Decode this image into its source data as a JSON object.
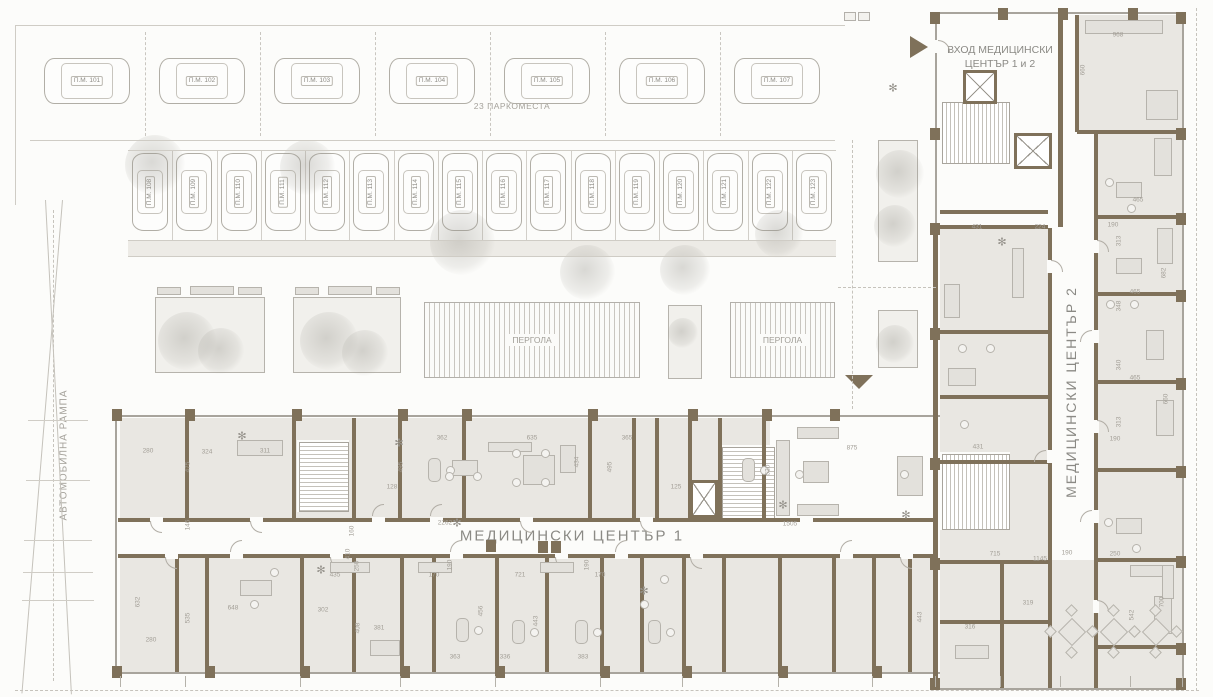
{
  "site": {
    "parking_total_label": "23 ПАРКОМЕСТА",
    "ramp_label": "АВТОМОБИЛНА РАМПА",
    "pergola_labels": [
      "ПЕРГОЛА",
      "ПЕРГОЛА"
    ]
  },
  "building": {
    "entrance_label": "ВХОД МЕДИЦИНСКИ ЦЕНТЪР 1 и 2",
    "center1_label": "МЕДИЦИНСКИ ЦЕНТЪР 1",
    "center2_label": "МЕДИЦИНСКИ ЦЕНТЪР 2"
  },
  "parking": {
    "row_top": [
      "П.М. 101",
      "П.М. 102",
      "П.М. 103",
      "П.М. 104",
      "П.М. 105",
      "П.М. 106",
      "П.М. 107"
    ],
    "row_middle": [
      "П.М. 108",
      "П.М. 109",
      "П.М. 110",
      "П.М. 111",
      "П.М. 112",
      "П.М. 113",
      "П.М. 114",
      "П.М. 115",
      "П.М. 116",
      "П.М. 117",
      "П.М. 118",
      "П.М. 119",
      "П.М. 120",
      "П.М. 121",
      "П.М. 122",
      "П.М. 123"
    ]
  },
  "colors": {
    "wall": "#7f715a",
    "floor": "#e9e7e2",
    "line_gray": "#a8a49c",
    "label_text": "#8b8a85",
    "dim_text": "#a29e96"
  },
  "dimensions": [
    {
      "t": "2262",
      "x": 445,
      "y": 523,
      "r": 0
    },
    {
      "t": "1505",
      "x": 790,
      "y": 524,
      "r": 0
    },
    {
      "t": "875",
      "x": 852,
      "y": 448,
      "r": 0
    },
    {
      "t": "362",
      "x": 442,
      "y": 438,
      "r": 0
    },
    {
      "t": "635",
      "x": 532,
      "y": 438,
      "r": 0
    },
    {
      "t": "365",
      "x": 627,
      "y": 438,
      "r": 0
    },
    {
      "t": "495",
      "x": 401,
      "y": 467,
      "r": 90
    },
    {
      "t": "495",
      "x": 610,
      "y": 467,
      "r": 90
    },
    {
      "t": "434",
      "x": 577,
      "y": 462,
      "r": 90
    },
    {
      "t": "128",
      "x": 392,
      "y": 487,
      "r": 0
    },
    {
      "t": "125",
      "x": 676,
      "y": 487,
      "r": 0
    },
    {
      "t": "324",
      "x": 207,
      "y": 452,
      "r": 0
    },
    {
      "t": "280",
      "x": 148,
      "y": 451,
      "r": 0
    },
    {
      "t": "311",
      "x": 265,
      "y": 451,
      "r": 0
    },
    {
      "t": "475",
      "x": 188,
      "y": 467,
      "r": 90
    },
    {
      "t": "146",
      "x": 188,
      "y": 525,
      "r": 90
    },
    {
      "t": "160",
      "x": 352,
      "y": 531,
      "r": 90
    },
    {
      "t": "410",
      "x": 348,
      "y": 554,
      "r": 90
    },
    {
      "t": "250",
      "x": 357,
      "y": 566,
      "r": 90
    },
    {
      "t": "632",
      "x": 138,
      "y": 602,
      "r": 90
    },
    {
      "t": "280",
      "x": 151,
      "y": 640,
      "r": 0
    },
    {
      "t": "535",
      "x": 188,
      "y": 618,
      "r": 90
    },
    {
      "t": "648",
      "x": 233,
      "y": 608,
      "r": 0
    },
    {
      "t": "302",
      "x": 323,
      "y": 610,
      "r": 0
    },
    {
      "t": "435",
      "x": 335,
      "y": 575,
      "r": 0
    },
    {
      "t": "381",
      "x": 379,
      "y": 628,
      "r": 0
    },
    {
      "t": "408",
      "x": 358,
      "y": 628,
      "r": 90
    },
    {
      "t": "363",
      "x": 455,
      "y": 657,
      "r": 0
    },
    {
      "t": "336",
      "x": 505,
      "y": 657,
      "r": 0
    },
    {
      "t": "383",
      "x": 583,
      "y": 657,
      "r": 0
    },
    {
      "t": "170",
      "x": 434,
      "y": 575,
      "r": 0
    },
    {
      "t": "721",
      "x": 520,
      "y": 575,
      "r": 0
    },
    {
      "t": "190",
      "x": 450,
      "y": 565,
      "r": 90
    },
    {
      "t": "456",
      "x": 481,
      "y": 611,
      "r": 90
    },
    {
      "t": "443",
      "x": 536,
      "y": 621,
      "r": 90
    },
    {
      "t": "190",
      "x": 587,
      "y": 565,
      "r": 90
    },
    {
      "t": "170",
      "x": 600,
      "y": 575,
      "r": 0
    },
    {
      "t": "715",
      "x": 995,
      "y": 554,
      "r": 0
    },
    {
      "t": "1145",
      "x": 1040,
      "y": 559,
      "r": 0
    },
    {
      "t": "190",
      "x": 1067,
      "y": 553,
      "r": 0
    },
    {
      "t": "250",
      "x": 1115,
      "y": 554,
      "r": 0
    },
    {
      "t": "319",
      "x": 1028,
      "y": 603,
      "r": 0
    },
    {
      "t": "316",
      "x": 970,
      "y": 627,
      "r": 0
    },
    {
      "t": "443",
      "x": 920,
      "y": 617,
      "r": 90
    },
    {
      "t": "542",
      "x": 1132,
      "y": 615,
      "r": 90
    },
    {
      "t": "700",
      "x": 1162,
      "y": 602,
      "r": 90
    },
    {
      "t": "431",
      "x": 977,
      "y": 227,
      "r": 0
    },
    {
      "t": "224",
      "x": 1040,
      "y": 227,
      "r": 0
    },
    {
      "t": "190",
      "x": 1113,
      "y": 225,
      "r": 0
    },
    {
      "t": "968",
      "x": 1118,
      "y": 35,
      "r": 0
    },
    {
      "t": "465",
      "x": 1138,
      "y": 200,
      "r": 0
    },
    {
      "t": "313",
      "x": 1119,
      "y": 241,
      "r": 90
    },
    {
      "t": "682",
      "x": 1164,
      "y": 273,
      "r": 90
    },
    {
      "t": "348",
      "x": 1119,
      "y": 306,
      "r": 90
    },
    {
      "t": "465",
      "x": 1135,
      "y": 292,
      "r": 0
    },
    {
      "t": "340",
      "x": 1119,
      "y": 365,
      "r": 90
    },
    {
      "t": "465",
      "x": 1135,
      "y": 378,
      "r": 0
    },
    {
      "t": "660",
      "x": 1166,
      "y": 399,
      "r": 90
    },
    {
      "t": "313",
      "x": 1119,
      "y": 422,
      "r": 90
    },
    {
      "t": "190",
      "x": 1115,
      "y": 439,
      "r": 0
    },
    {
      "t": "431",
      "x": 978,
      "y": 447,
      "r": 0
    },
    {
      "t": "660",
      "x": 1083,
      "y": 70,
      "r": 90
    },
    {
      "t": "520",
      "x": 768,
      "y": 470,
      "r": 90
    }
  ]
}
